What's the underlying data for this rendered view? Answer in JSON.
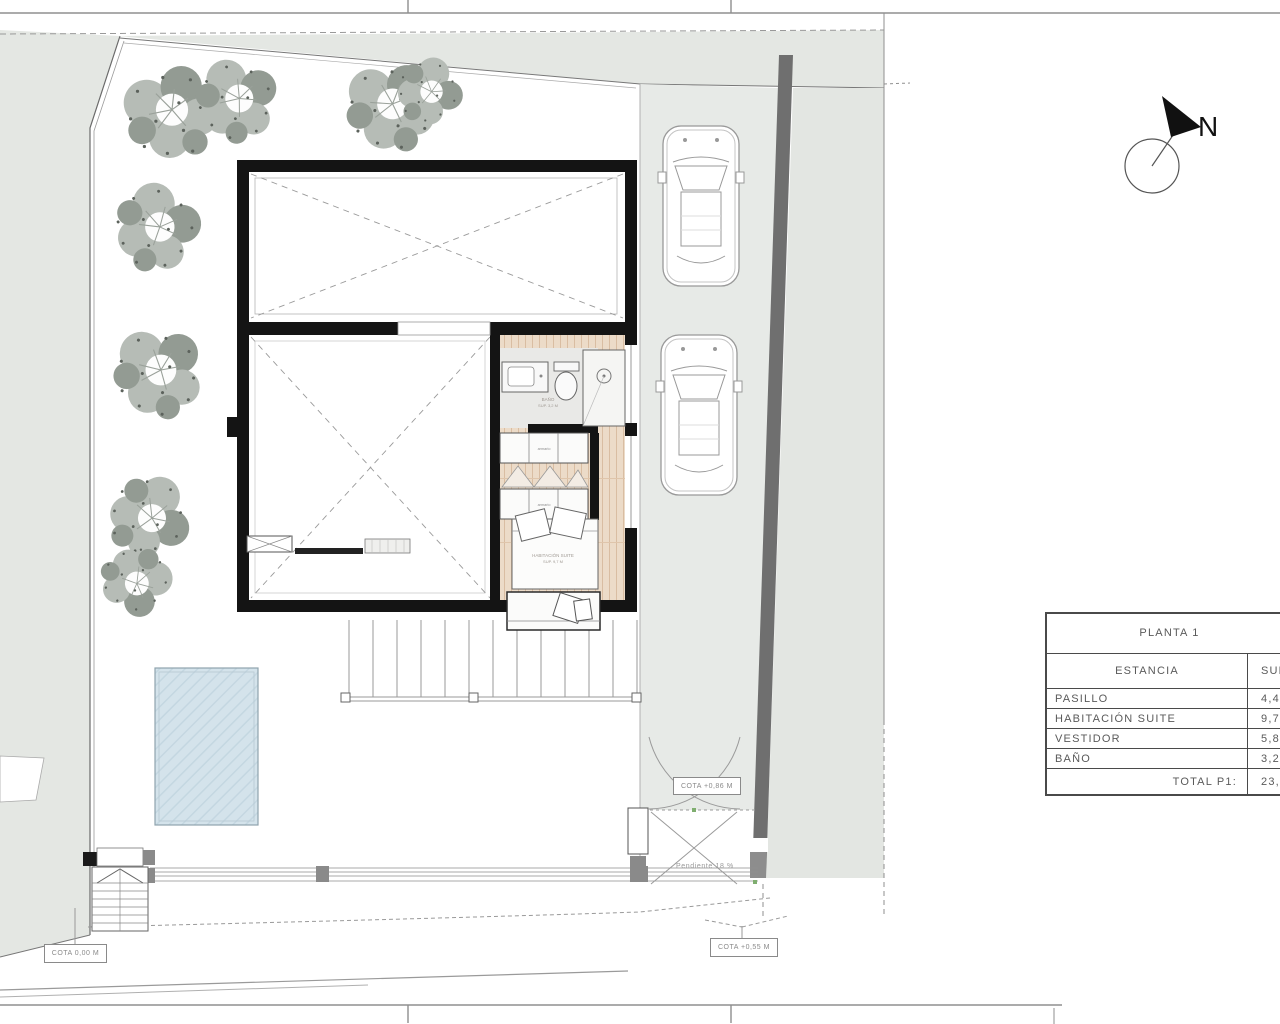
{
  "sheet": {
    "type": "architectural site / floor plan",
    "north_label": "N"
  },
  "annotations": {
    "cota_ground": "COTA 0,00 M",
    "cota_street": "COTA +0,55 M",
    "cota_gate": "COTA +0,86 M",
    "slope_note": "Pendiente 18 %"
  },
  "room_labels": {
    "bath_name": "BAÑO",
    "bath_area": "SUP. 3,2 M",
    "suite_name": "HABITACIÓN SUITE",
    "suite_area": "SUP. 9,7 M",
    "wardrobe_top": "armario",
    "wardrobe_bottom": "armario"
  },
  "table": {
    "title": "PLANTA 1",
    "col_room": "ESTANCIA",
    "col_area": "SUPERFICIE",
    "rows": [
      {
        "name": "PASILLO",
        "value": "4,4"
      },
      {
        "name": "HABITACIÓN SUITE",
        "value": "9,7"
      },
      {
        "name": "VESTIDOR",
        "value": "5,8"
      },
      {
        "name": "BAÑO",
        "value": "3,2"
      }
    ],
    "total_label": "TOTAL P1:",
    "total_value": "23,"
  },
  "colors": {
    "site_gray": "#e4e7e3",
    "drive_gray": "#e7eae7",
    "wall_dark": "#6f6f6f",
    "plan_black": "#141414",
    "wood_floor": "#ecdbc8",
    "pool_blue": "#d4e3eb",
    "tree_light": "#b6bcb6",
    "tree_dark": "#939b93"
  }
}
